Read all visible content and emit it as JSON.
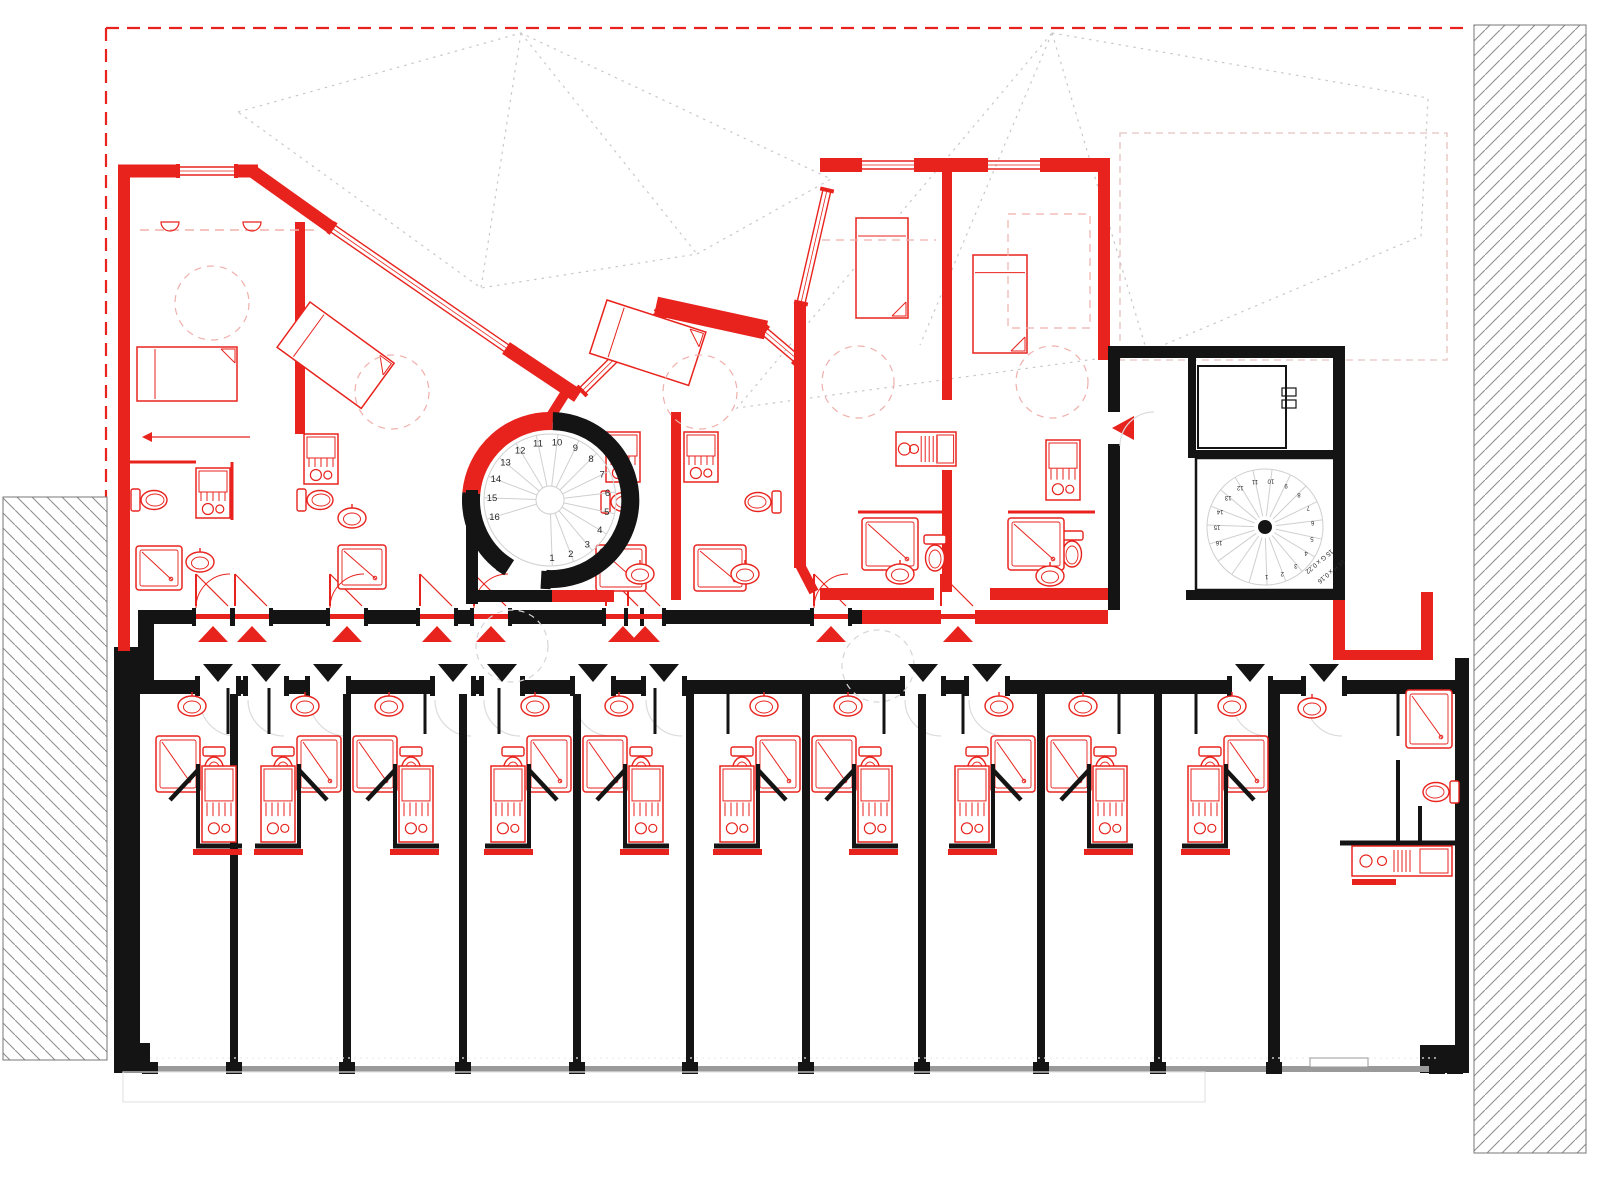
{
  "colors": {
    "wall_red": "#e8231d",
    "wall_black": "#141414",
    "boundary_red": "#e8231d",
    "roof_dot_gray": "#c8c8c8",
    "roof_dash_pink": "#e4c3c0",
    "hatch_line_gray": "#8f8f8f",
    "tread_gray": "#cfcfcf",
    "door_arc_gray": "#dcdcdc",
    "dashed_interior_red": "#efb0ac",
    "window_band_gray": "#9a9a9a",
    "balcony_gray": "#e4e4e4",
    "text_dark": "#2a2a2a"
  },
  "stairs": {
    "left": {
      "steps": [
        "1",
        "2",
        "3",
        "4",
        "5",
        "6",
        "7",
        "8",
        "9",
        "10",
        "11",
        "12",
        "13",
        "14",
        "15",
        "16"
      ]
    },
    "right": {
      "steps": [
        "1",
        "2",
        "3",
        "4",
        "5",
        "6",
        "7",
        "8",
        "9",
        "10",
        "11",
        "12",
        "13",
        "14",
        "15",
        "16"
      ],
      "annotations": [
        "15 G x 0,22",
        "16 H x 0,16"
      ]
    }
  }
}
